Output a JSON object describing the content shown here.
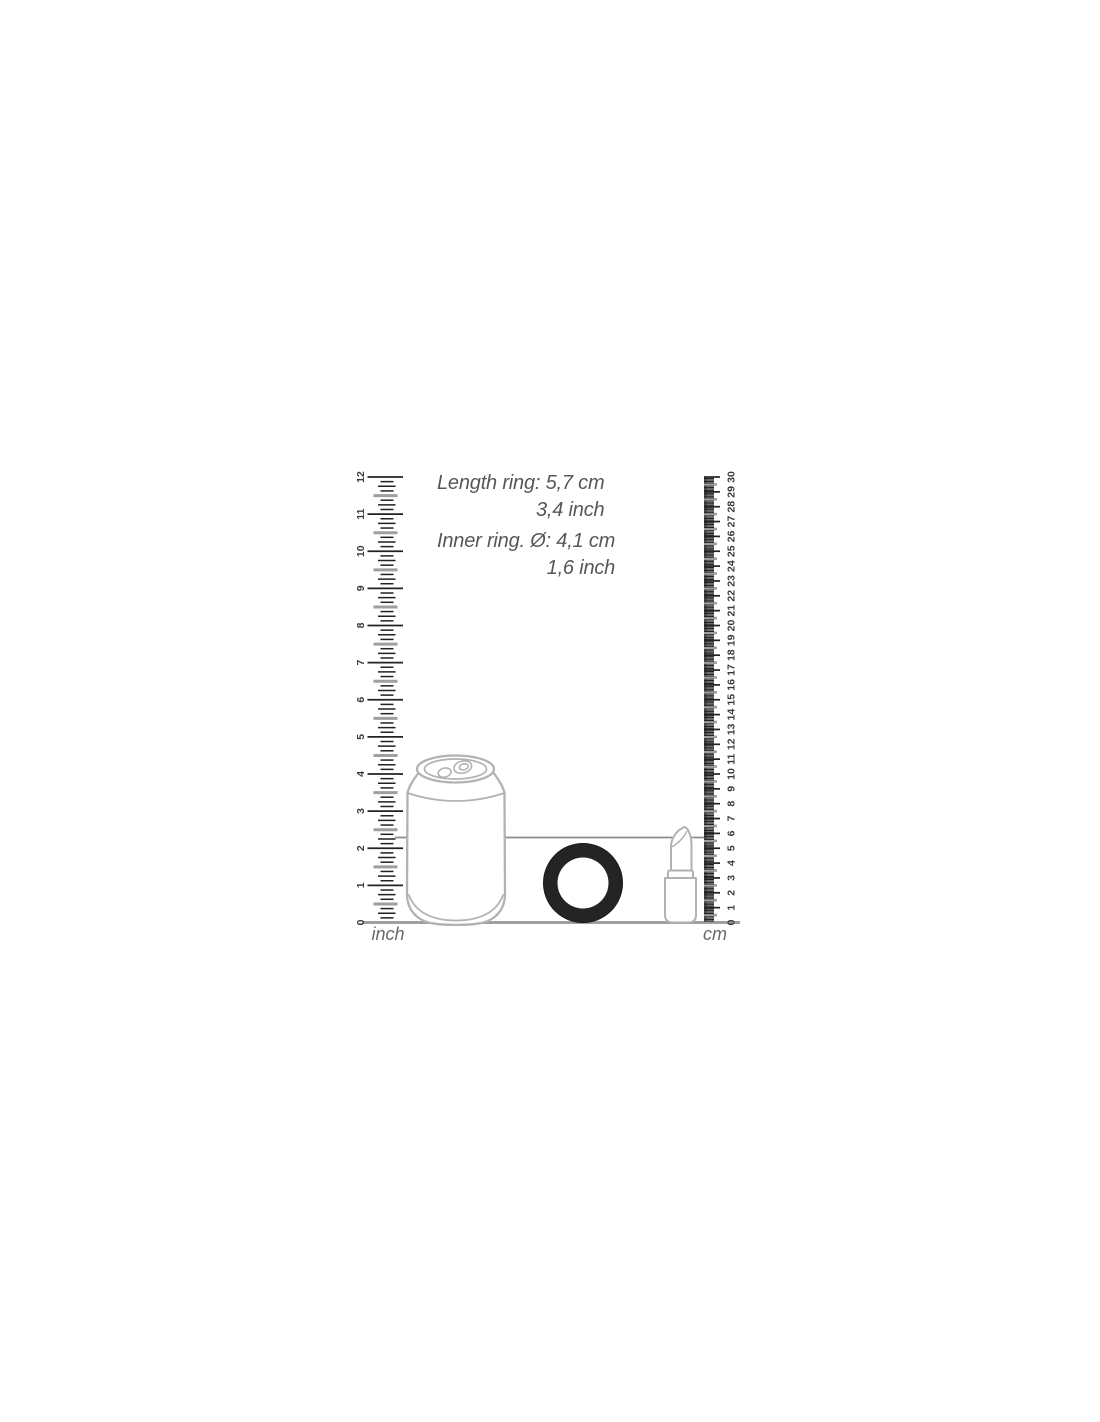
{
  "measurements": {
    "length_ring": {
      "metric": "Length ring: 5,7 cm",
      "imperial": "3,4 inch"
    },
    "inner_ring": {
      "metric": "Inner ring. Ø: 4,1 cm",
      "imperial": "1,6 inch"
    }
  },
  "rulers": {
    "inch": {
      "label": "inch",
      "min": 0,
      "max": 12,
      "minor_per_unit": 8,
      "labels": [
        "0",
        "1",
        "2",
        "3",
        "4",
        "5",
        "6",
        "7",
        "8",
        "9",
        "10",
        "11",
        "12"
      ]
    },
    "cm": {
      "label": "cm",
      "min": 0,
      "max": 30,
      "minor_per_unit": 10,
      "labels": [
        "0",
        "1",
        "2",
        "3",
        "4",
        "5",
        "6",
        "7",
        "8",
        "9",
        "10",
        "11",
        "12",
        "13",
        "14",
        "15",
        "16",
        "17",
        "18",
        "19",
        "20",
        "21",
        "22",
        "23",
        "24",
        "25",
        "26",
        "27",
        "28",
        "29",
        "30"
      ]
    }
  },
  "objects": {
    "can": "soda-can",
    "ring": "black-ring-product",
    "lipstick": "lipstick"
  },
  "colors": {
    "outline_gray": "#b2b2b2",
    "tick_black": "#232122",
    "tick_gray": "#9d9fa2",
    "number_gray": "#3a3a3c",
    "annotation_gray": "#57575a",
    "reference_line_gray": "#8d8d8d",
    "ring_black": "#242424",
    "background": "#ffffff"
  }
}
